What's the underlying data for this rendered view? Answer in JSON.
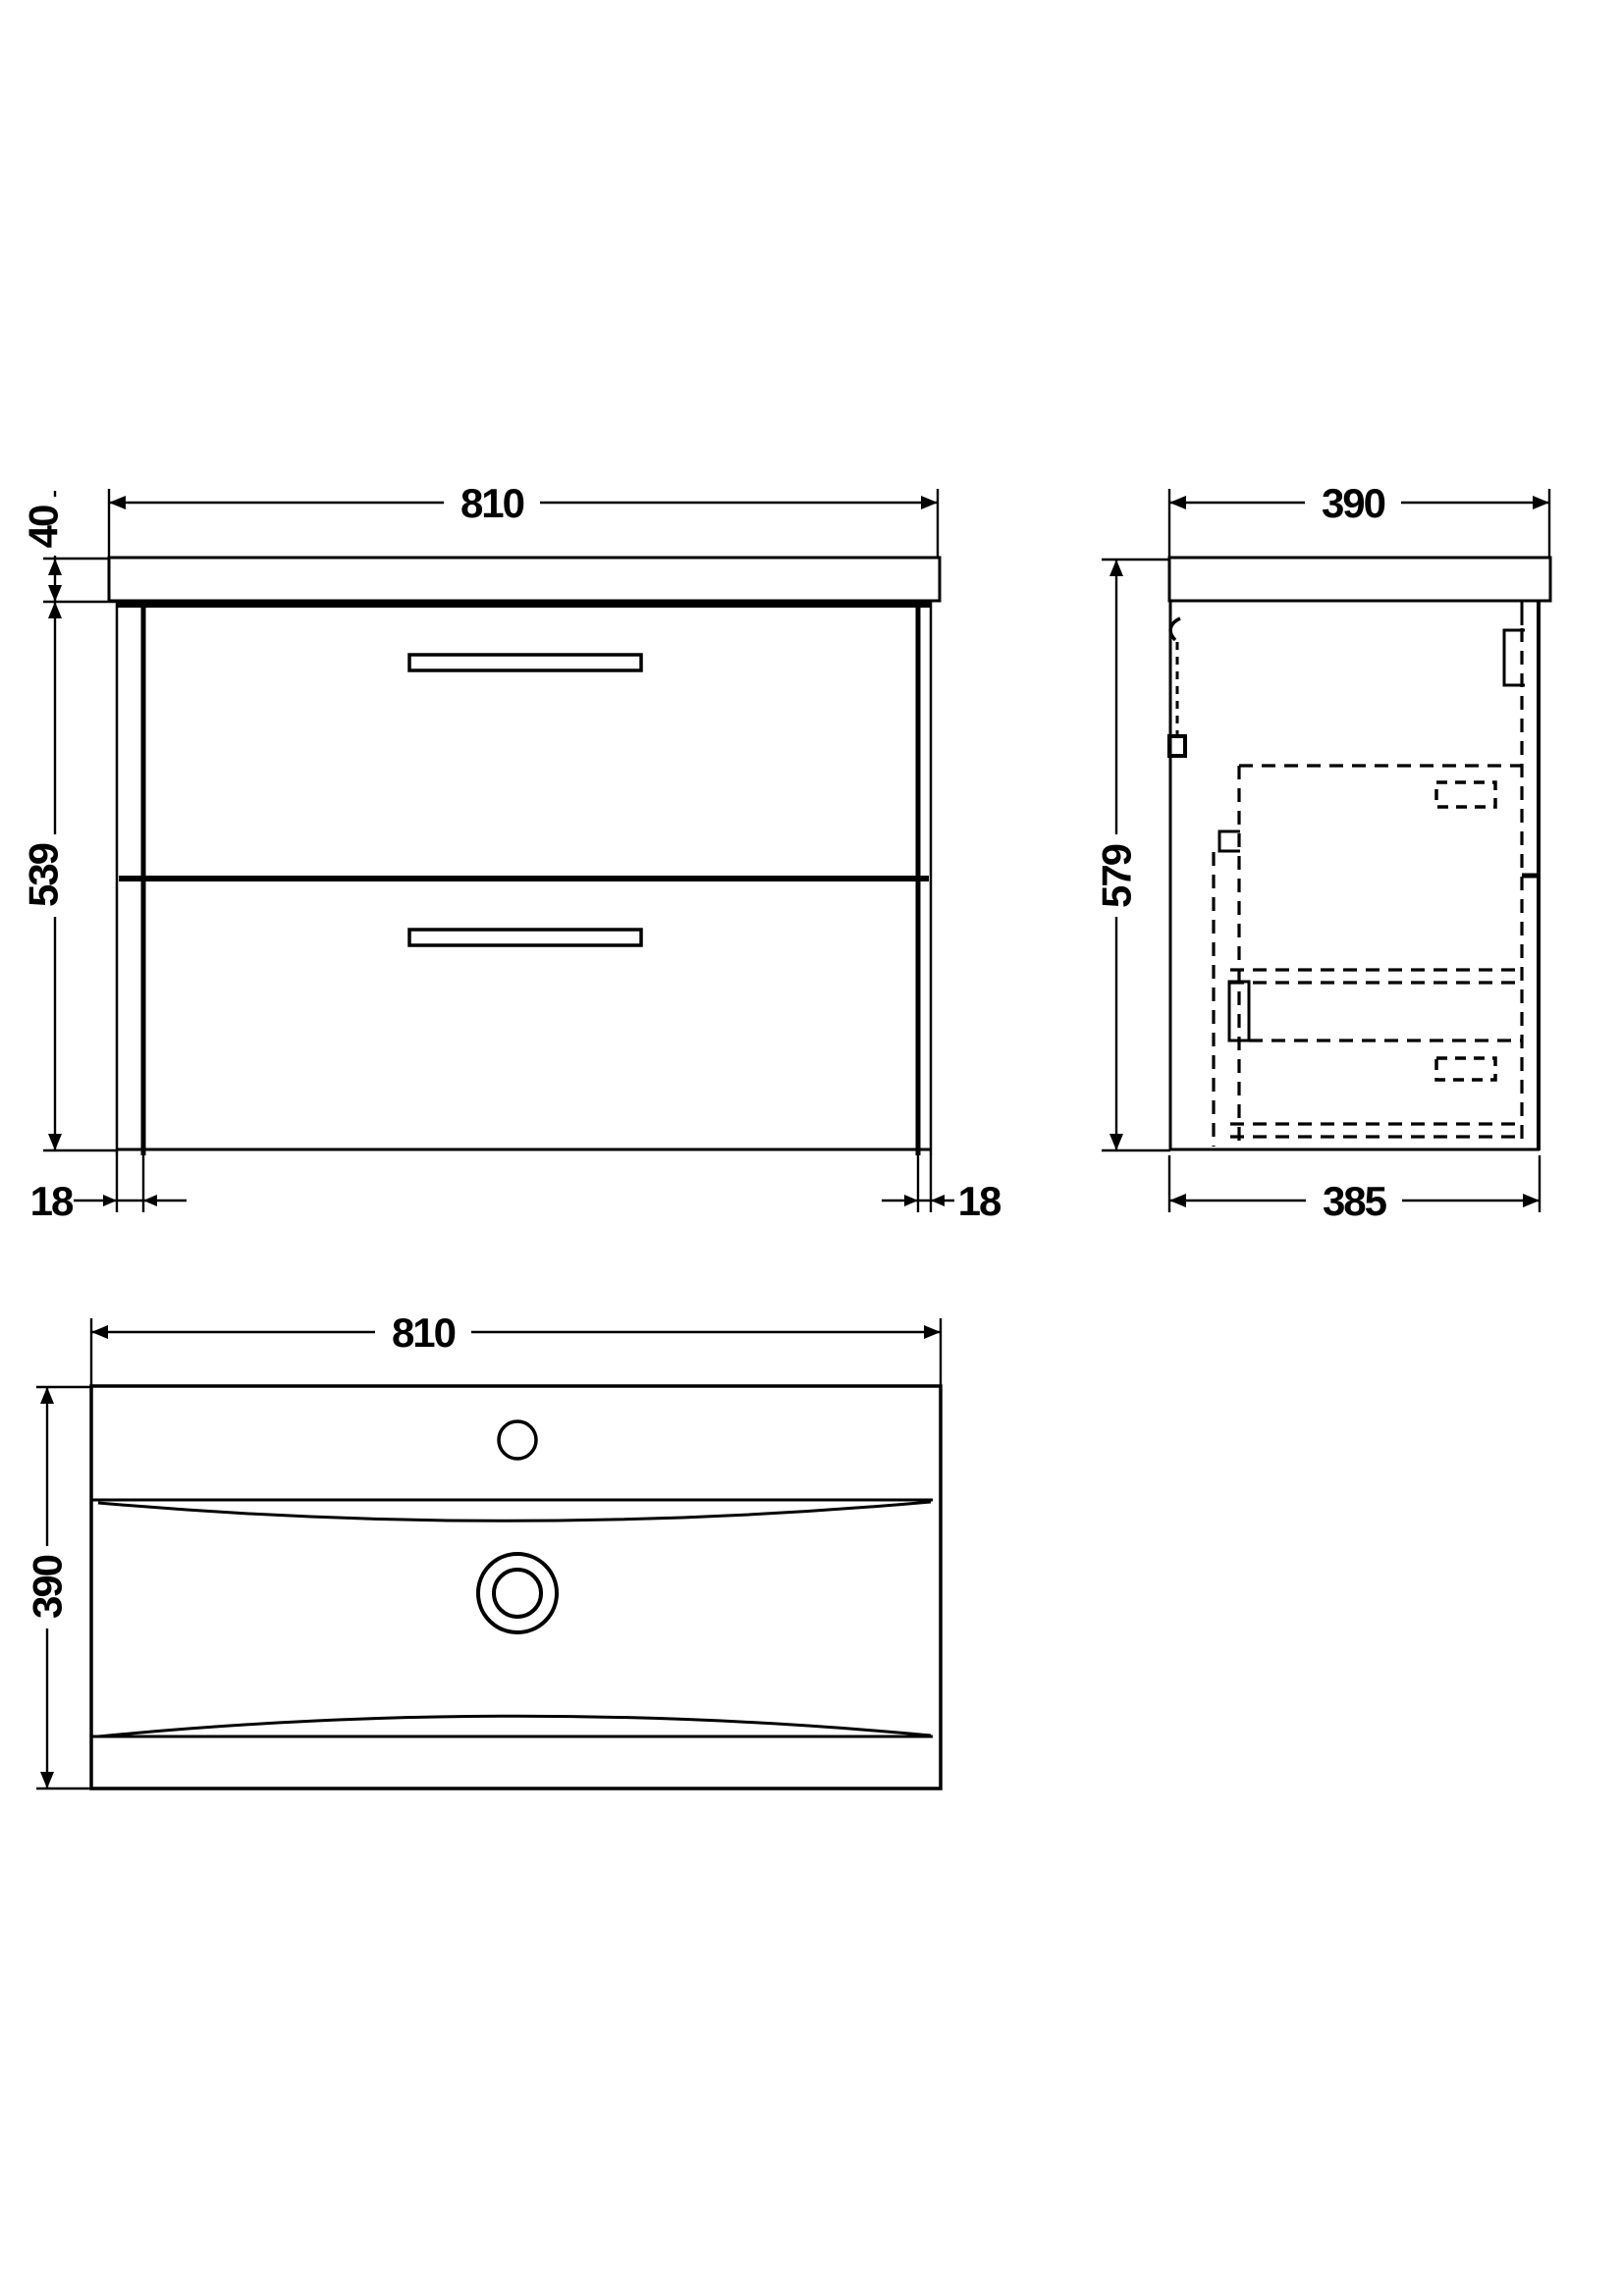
{
  "drawing": {
    "background_color": "#ffffff",
    "line_color": "#000000",
    "views": {
      "front": {
        "label": "front-elevation-vanity-unit",
        "width_mm": "810",
        "worktop_thickness_mm": "40",
        "cabinet_height_mm": "539",
        "left_panel_mm": "18",
        "right_panel_mm": "18"
      },
      "side": {
        "label": "side-elevation-vanity-unit",
        "depth_mm": "390",
        "overall_height_mm": "579",
        "cabinet_depth_mm": "385"
      },
      "plan": {
        "label": "basin-plan-view",
        "width_mm": "810",
        "depth_mm": "390"
      }
    }
  }
}
